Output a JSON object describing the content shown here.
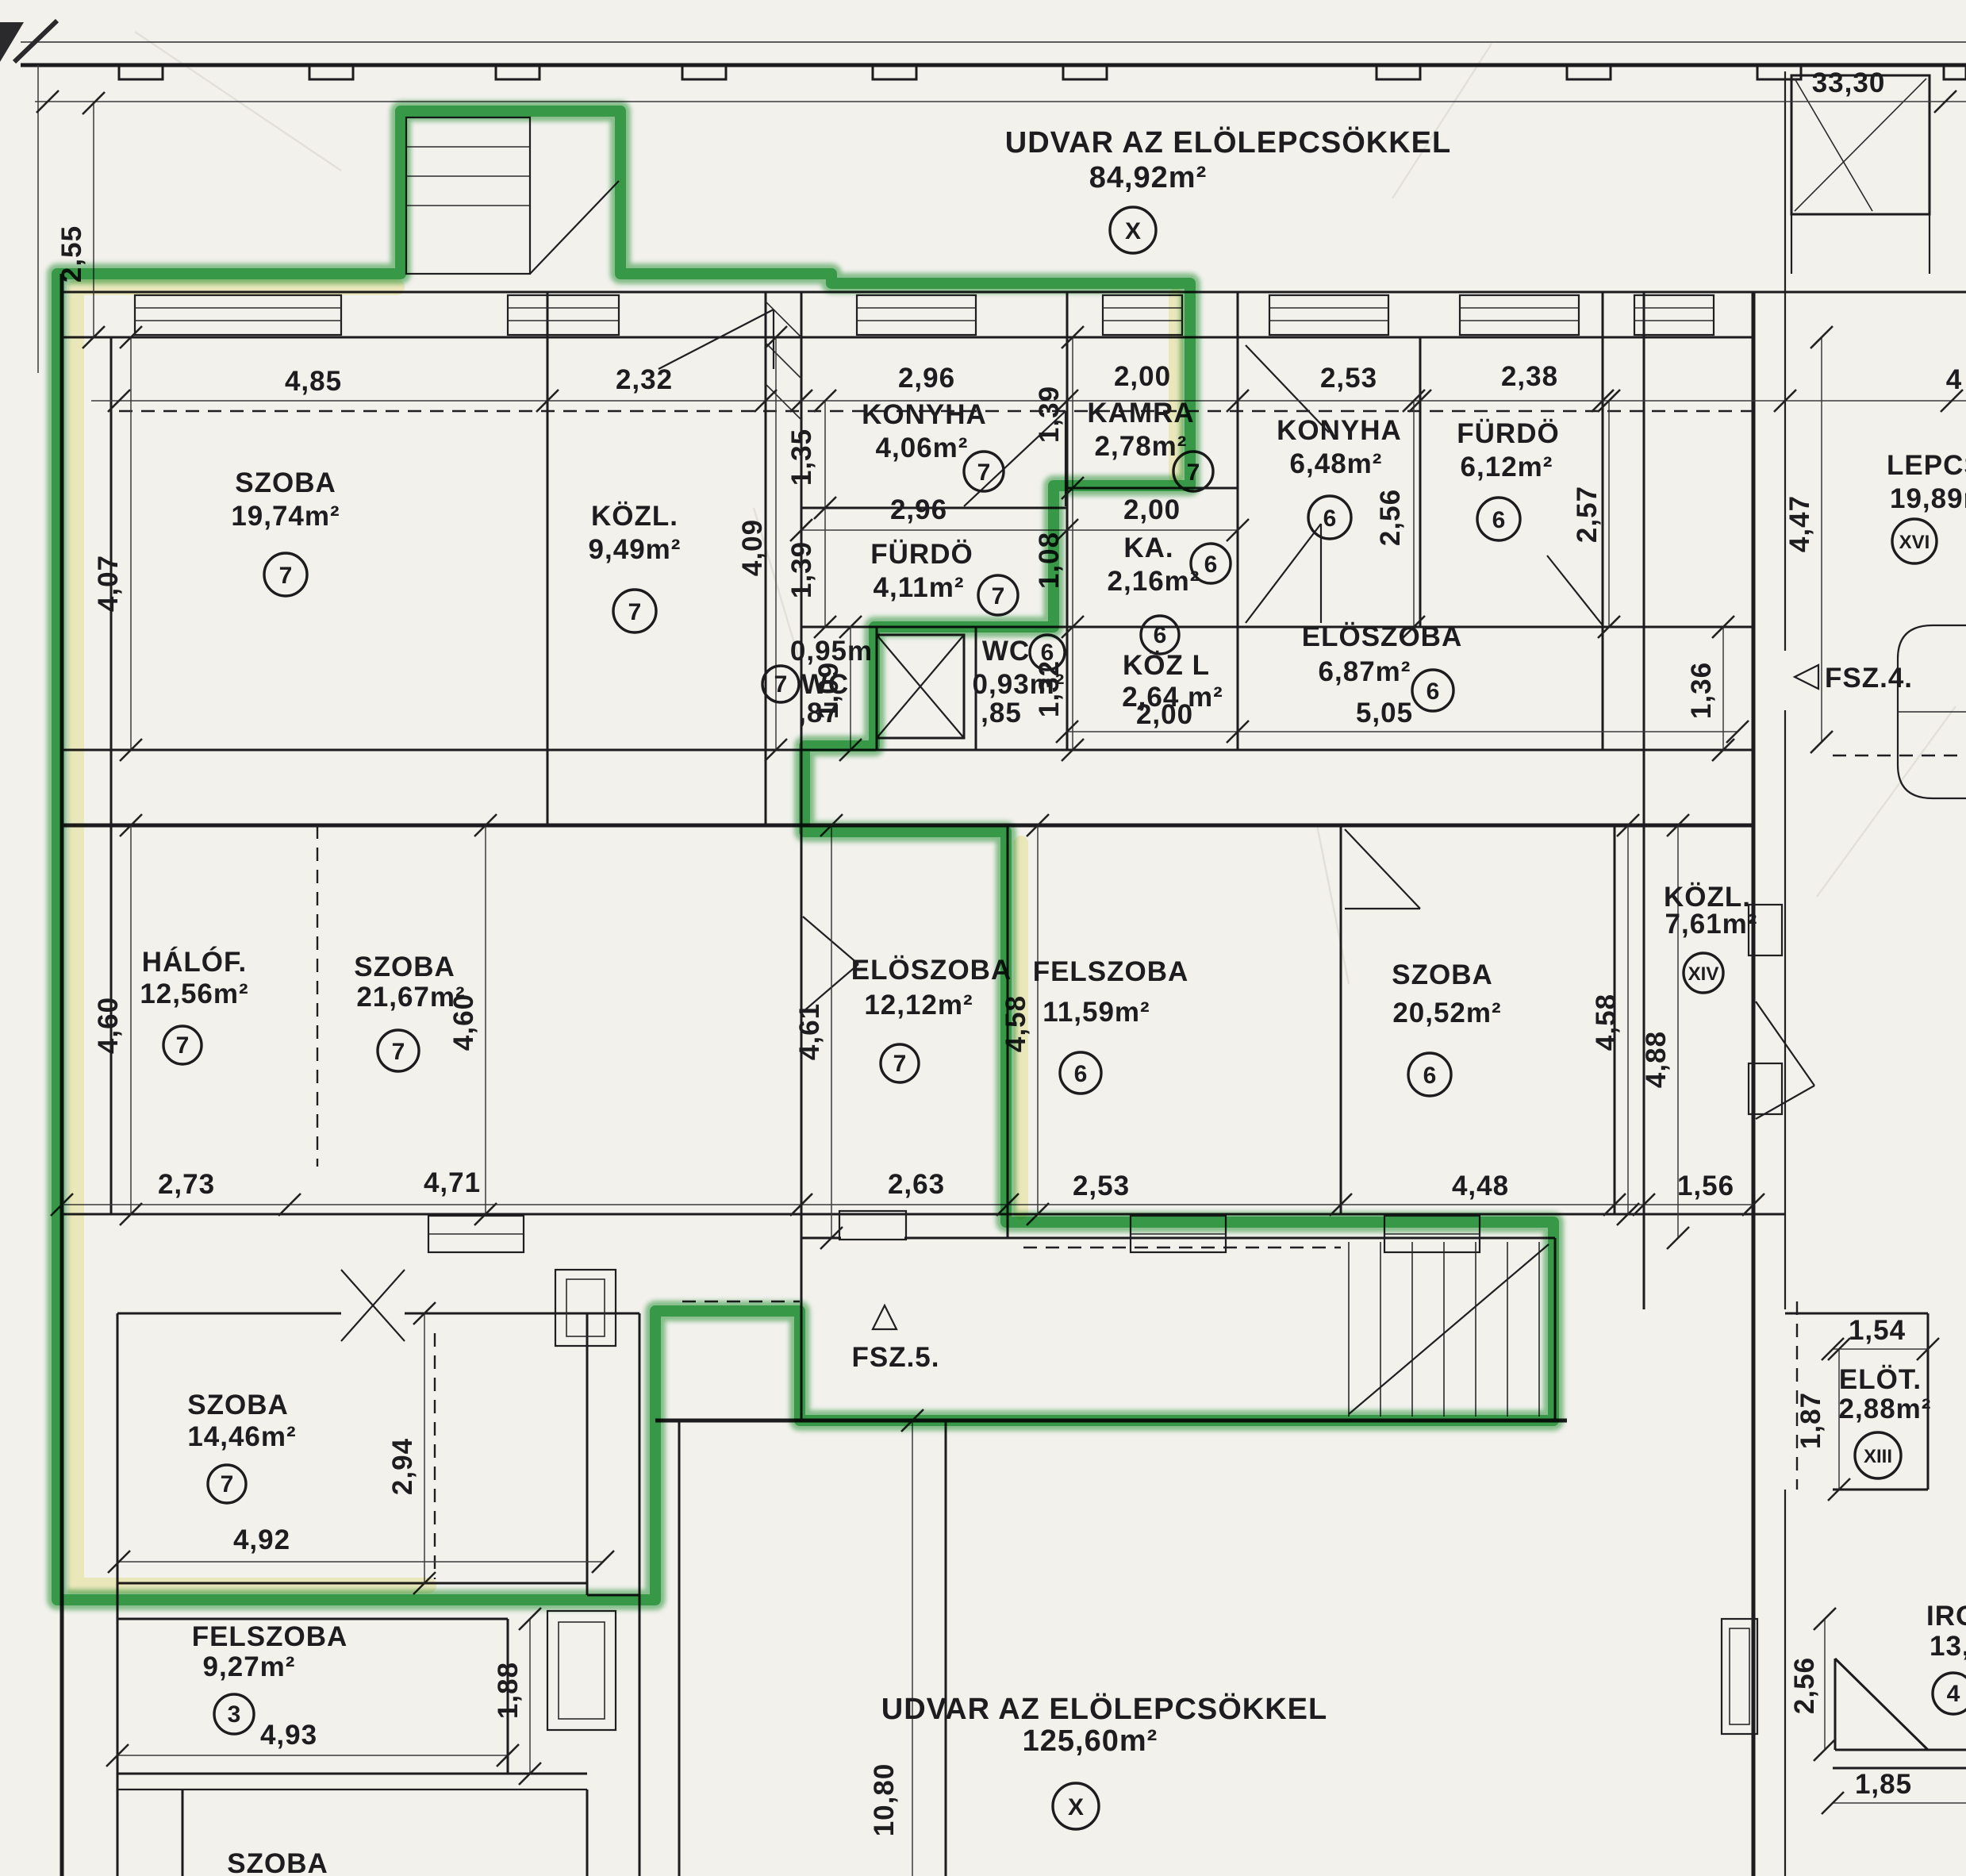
{
  "colors": {
    "paper": "#f2f1ec",
    "ink": "#1d1d20",
    "highlight_green": "#2d9c41",
    "highlight_yellow": "#f1ec9f"
  },
  "overall_dim": "33,30",
  "courtyard_top": {
    "name": "UDVAR AZ ELÖLEPCSÖKKEL",
    "area": "84,92m²",
    "circ": "X"
  },
  "courtyard_bottom": {
    "name": "UDVAR AZ ELÖLEPCSÖKKEL",
    "area": "125,60m²",
    "circ": "X"
  },
  "entry4": {
    "label": "FSZ.4."
  },
  "entry5": {
    "label": "FSZ.5."
  },
  "rooms": [
    {
      "name": "SZOBA",
      "area": "19,74m²",
      "circ": "7"
    },
    {
      "name": "KÖZL.",
      "area": "9,49m²",
      "circ": "7"
    },
    {
      "name": "KONYHA",
      "area": "4,06m²",
      "circ": "7"
    },
    {
      "name": "FÜRDÖ",
      "area": "4,11m²",
      "circ": "7"
    },
    {
      "name": "WC",
      "area": "0,95m",
      "circ": "7",
      "sub": ",87"
    },
    {
      "name": "KAMRA",
      "area": "2,78m²",
      "circ": "7"
    },
    {
      "name": "KA.",
      "area": "2,16m²",
      "circ": "6"
    },
    {
      "name": "WC",
      "area": "0,93m²",
      "circ": "6",
      "sub": ",85"
    },
    {
      "name": "KÖZ L",
      "area": "2,64 m²",
      "circ": "6"
    },
    {
      "name": "KONYHA",
      "area": "6,48m²",
      "circ": "6"
    },
    {
      "name": "FÜRDÖ",
      "area": "6,12m²",
      "circ": "6"
    },
    {
      "name": "ELÖSZOBA",
      "area": "6,87m²",
      "circ": "6"
    },
    {
      "name": "LEPCS",
      "area": "19,89m",
      "circ": "XVI"
    },
    {
      "name": "HÁLÓF.",
      "area": "12,56m²",
      "circ": "7"
    },
    {
      "name": "SZOBA",
      "area": "21,67m²",
      "circ": "7"
    },
    {
      "name": "ELÖSZOBA",
      "area": "12,12m²",
      "circ": "7"
    },
    {
      "name": "FELSZOBA",
      "area": "11,59m²",
      "circ": "6"
    },
    {
      "name": "SZOBA",
      "area": "20,52m²",
      "circ": "6"
    },
    {
      "name": "KÖZL.",
      "area": "7,61m²",
      "circ": "XIV"
    },
    {
      "name": "SZOBA",
      "area": "14,46m²",
      "circ": "7"
    },
    {
      "name": "FELSZOBA",
      "area": "9,27m²",
      "circ": "3"
    },
    {
      "name": "ELÖT.",
      "area": "2,88m²",
      "circ": "XIII"
    },
    {
      "name": "IRO",
      "area": "13,7",
      "circ": "4"
    },
    {
      "name": "SZOBA",
      "area": "",
      "circ": ""
    }
  ],
  "dims": [
    "33,30",
    "2,55",
    "4,85",
    "2,32",
    "2,96",
    "2,00",
    "2,53",
    "2,38",
    "4",
    "4,07",
    "4,09",
    "1,35",
    "2,96",
    "1,39",
    "1,09",
    "1,39",
    "2,00",
    "1,08",
    "1,32",
    "2,00",
    "5,05",
    "2,56",
    "2,57",
    "4,47",
    "1,36",
    "4,60",
    "4,60",
    "4,61",
    "4,58",
    "4,58",
    "4,88",
    "2,73",
    "4,71",
    "2,63",
    "2,53",
    "4,48",
    "1,56",
    "2,94",
    "4,92",
    "1,88",
    "10,80",
    "4,93",
    "1,54",
    "1,87",
    "2,56",
    "1,85"
  ]
}
